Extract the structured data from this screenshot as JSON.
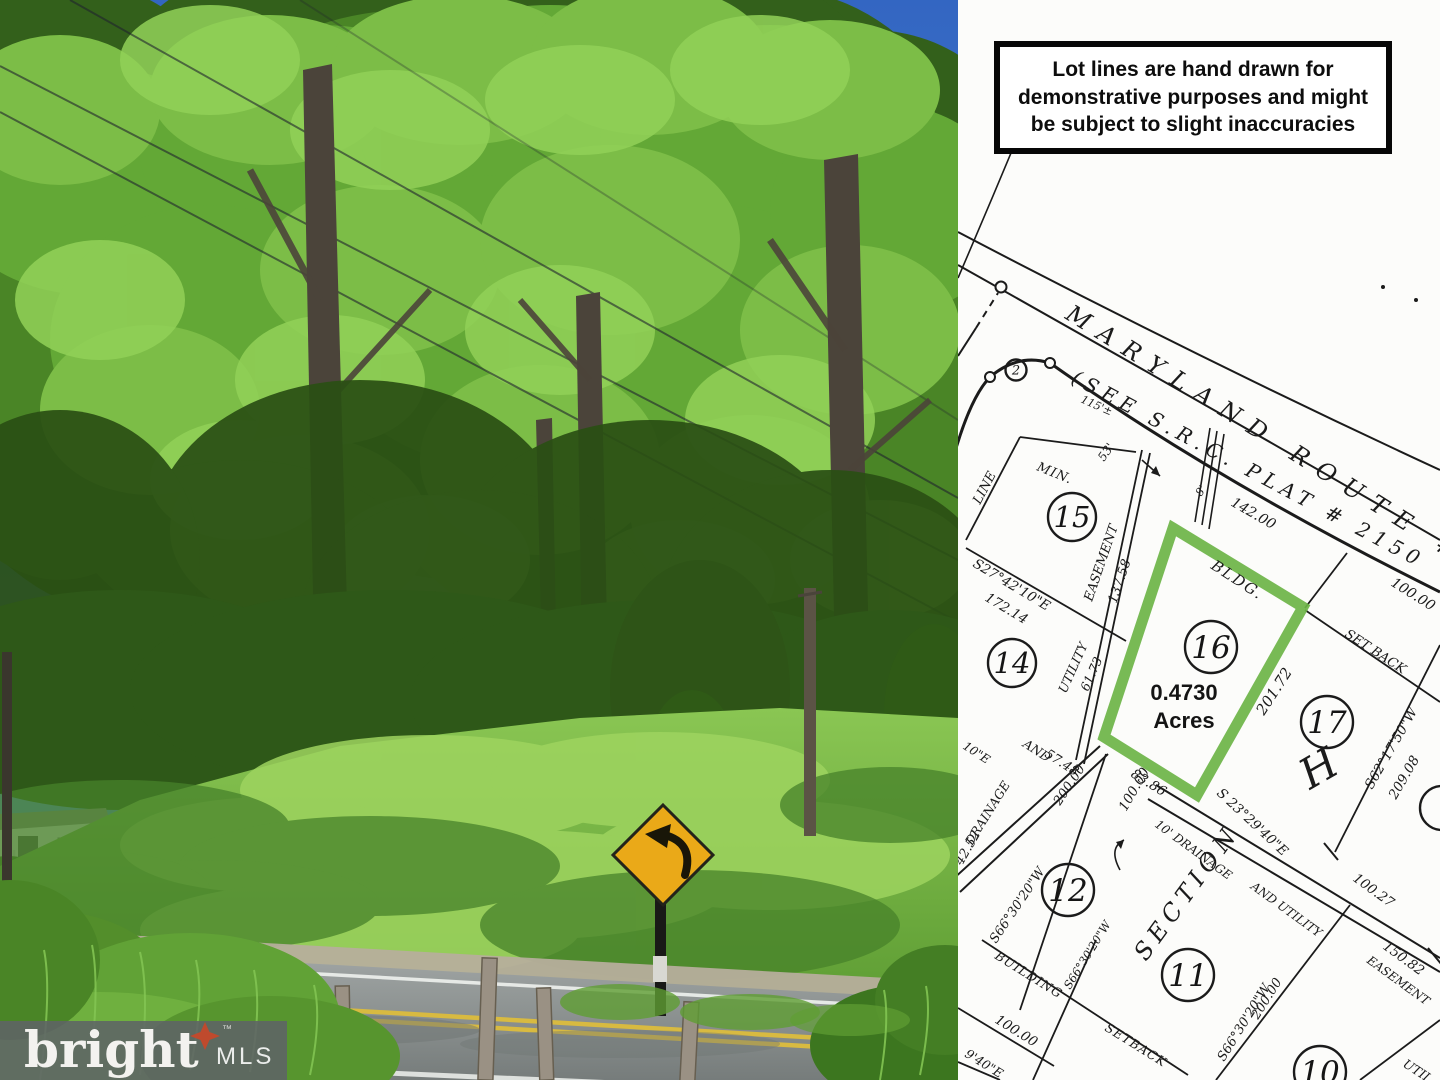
{
  "disclaimer": {
    "text": "Lot lines are hand drawn for demonstrative purposes and might be subject to slight inaccuracies"
  },
  "watermark": {
    "brand": "bright",
    "trademark": "™",
    "suffix": "MLS",
    "star_color": "#bf4a2d"
  },
  "photo": {
    "description": "wooded lot with lawn, white house, covered RV, curve-warning road sign, rural road with double yellow line, wooden fence posts",
    "sign_color": "#eaa918",
    "sky_color": "#3569c6"
  },
  "plat": {
    "highlight_color": "#6cb446",
    "area_label": {
      "line1": "0.4730",
      "line2": "Acres"
    },
    "lots": [
      {
        "number": "2",
        "x": 58,
        "y": 370,
        "r": 10.5
      },
      {
        "number": "15",
        "x": 114,
        "y": 517,
        "r": 24
      },
      {
        "number": "14",
        "x": 54,
        "y": 663,
        "r": 24
      },
      {
        "number": "16",
        "x": 253,
        "y": 647,
        "r": 26
      },
      {
        "number": "17",
        "x": 369,
        "y": 722,
        "r": 26
      },
      {
        "number": "12",
        "x": 110,
        "y": 890,
        "r": 26
      },
      {
        "number": "11",
        "x": 230,
        "y": 975,
        "r": 26
      },
      {
        "number": "10",
        "x": 362,
        "y": 1072,
        "r": 26
      },
      {
        "number": "",
        "x": 484,
        "y": 808,
        "r": 22
      }
    ],
    "labels": [
      {
        "text": "MARYLAND ROUTE #",
        "x": 106,
        "y": 318,
        "rot": 32,
        "size": 24,
        "ls": 12
      },
      {
        "text": "(SEE S.R.C. PLAT # 2150",
        "x": 112,
        "y": 382,
        "rot": 28,
        "size": 20,
        "ls": 6
      },
      {
        "text": "142.00",
        "x": 272,
        "y": 505,
        "rot": 30,
        "size": 14
      },
      {
        "text": "100.00",
        "x": 432,
        "y": 585,
        "rot": 32,
        "size": 14
      },
      {
        "text": "115'±",
        "x": 122,
        "y": 402,
        "rot": 24,
        "size": 11
      },
      {
        "text": "53'",
        "x": 146,
        "y": 462,
        "rot": -55,
        "size": 12
      },
      {
        "text": "8'",
        "x": 243,
        "y": 497,
        "rot": -55,
        "size": 11
      },
      {
        "text": "MIN.",
        "x": 78,
        "y": 470,
        "rot": 22,
        "size": 13,
        "ls": 1
      },
      {
        "text": "LINE",
        "x": 22,
        "y": 505,
        "rot": -62,
        "size": 13
      },
      {
        "text": "S27°42'10\"E",
        "x": 14,
        "y": 566,
        "rot": 31,
        "size": 13.5
      },
      {
        "text": "172.14",
        "x": 26,
        "y": 600,
        "rot": 31,
        "size": 13.5
      },
      {
        "text": "EASEMENT",
        "x": 134,
        "y": 602,
        "rot": -71,
        "size": 13
      },
      {
        "text": "137.58",
        "x": 158,
        "y": 604,
        "rot": -71,
        "size": 13
      },
      {
        "text": "BLDG.",
        "x": 252,
        "y": 568,
        "rot": 33,
        "size": 15,
        "ls": 2
      },
      {
        "text": "SET BACK",
        "x": 386,
        "y": 636,
        "rot": 33,
        "size": 13
      },
      {
        "text": "201.72",
        "x": 306,
        "y": 716,
        "rot": -57,
        "size": 15
      },
      {
        "text": "S62°17'50\"W",
        "x": 414,
        "y": 790,
        "rot": -60,
        "size": 13.5
      },
      {
        "text": "209.08",
        "x": 438,
        "y": 800,
        "rot": -60,
        "size": 13.5
      },
      {
        "text": "83.86",
        "x": 172,
        "y": 776,
        "rot": 32,
        "size": 13.5
      },
      {
        "text": "S 23°29'40\"E",
        "x": 258,
        "y": 794,
        "rot": 43,
        "size": 13.5
      },
      {
        "text": "100.27",
        "x": 394,
        "y": 880,
        "rot": 36,
        "size": 13.5
      },
      {
        "text": "150.82",
        "x": 424,
        "y": 948,
        "rot": 36,
        "size": 13.5
      },
      {
        "text": "10' DRAINAGE",
        "x": 196,
        "y": 826,
        "rot": 36,
        "size": 12
      },
      {
        "text": "AND UTILITY",
        "x": 292,
        "y": 888,
        "rot": 36,
        "size": 12
      },
      {
        "text": "EASEMENT",
        "x": 408,
        "y": 962,
        "rot": 36,
        "size": 12
      },
      {
        "text": "100.00",
        "x": 168,
        "y": 812,
        "rot": -60,
        "size": 13.5
      },
      {
        "text": "UTILITY",
        "x": 108,
        "y": 694,
        "rot": -66,
        "size": 12.5
      },
      {
        "text": "61.73",
        "x": 130,
        "y": 692,
        "rot": -66,
        "size": 12.5
      },
      {
        "text": "AND",
        "x": 64,
        "y": 746,
        "rot": 33,
        "size": 12.5
      },
      {
        "text": "57.48",
        "x": 86,
        "y": 756,
        "rot": 33,
        "size": 13
      },
      {
        "text": "DRAINAGE",
        "x": 14,
        "y": 846,
        "rot": -58,
        "size": 12.5
      },
      {
        "text": "42.52",
        "x": 4,
        "y": 866,
        "rot": -60,
        "size": 13
      },
      {
        "text": "S66°30'20\"W",
        "x": 38,
        "y": 944,
        "rot": -56,
        "size": 13
      },
      {
        "text": "200.00",
        "x": 102,
        "y": 806,
        "rot": -56,
        "size": 13
      },
      {
        "text": "10\"E",
        "x": 4,
        "y": 748,
        "rot": 33,
        "size": 12
      },
      {
        "text": "SECTION",
        "x": 188,
        "y": 962,
        "rot": -54,
        "size": 24,
        "ls": 6
      },
      {
        "text": "S66°30'20\"W",
        "x": 266,
        "y": 1062,
        "rot": -58,
        "size": 13
      },
      {
        "text": "200.00",
        "x": 300,
        "y": 1020,
        "rot": -58,
        "size": 13
      },
      {
        "text": "BUILDING",
        "x": 36,
        "y": 958,
        "rot": 32,
        "size": 12.5,
        "ls": 1
      },
      {
        "text": "S66°30'20\"W",
        "x": 112,
        "y": 990,
        "rot": -58,
        "size": 11.5
      },
      {
        "text": "SETBACK",
        "x": 146,
        "y": 1030,
        "rot": 32,
        "size": 12.5,
        "ls": 1
      },
      {
        "text": "100.00",
        "x": 36,
        "y": 1022,
        "rot": 32,
        "size": 13.5
      },
      {
        "text": "9'40\"E",
        "x": 6,
        "y": 1056,
        "rot": 32,
        "size": 12.5
      },
      {
        "text": "UTIL",
        "x": 444,
        "y": 1066,
        "rot": 33,
        "size": 12.5
      },
      {
        "text": "H",
        "x": 352,
        "y": 790,
        "rot": -30,
        "size": 42
      }
    ]
  }
}
